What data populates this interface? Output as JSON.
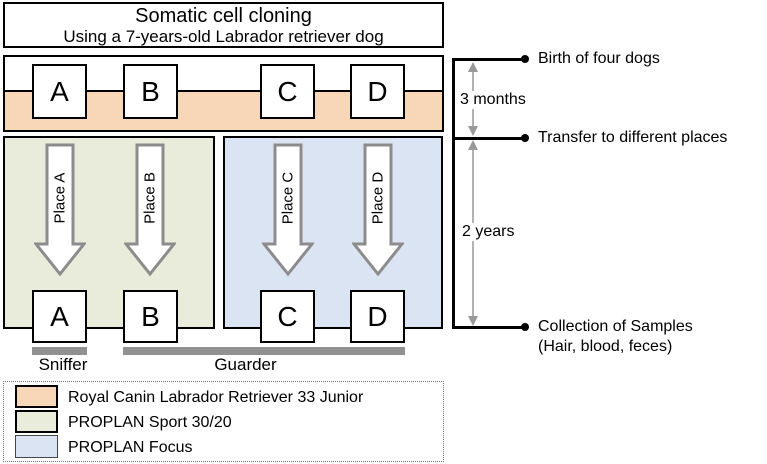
{
  "title": {
    "line1": "Somatic cell cloning",
    "line2": "Using a 7-years-old Labrador retriever dog"
  },
  "clones": {
    "top_boxes": [
      "A",
      "B",
      "C",
      "D"
    ],
    "place_arrows": [
      "Place A",
      "Place B",
      "Place C",
      "Place D"
    ],
    "bottom_boxes": [
      "A",
      "B",
      "C",
      "D"
    ]
  },
  "roles": {
    "sniffer": "Sniffer",
    "guarder": "Guarder"
  },
  "timeline": {
    "events": [
      {
        "label": "Birth of four dogs"
      },
      {
        "label": "Transfer to different places"
      },
      {
        "label": "Collection of Samples",
        "label2": "(Hair, blood, feces)"
      }
    ],
    "durations": [
      "3 months",
      "2 years"
    ]
  },
  "legend": {
    "items": [
      {
        "label": "Royal Canin Labrador Retriever 33 Junior",
        "color": "#F8D7B8"
      },
      {
        "label": "PROPLAN Sport 30/20",
        "color": "#E9ECDA"
      },
      {
        "label": "PROPLAN Focus",
        "color": "#DBE4F2"
      }
    ]
  },
  "colors": {
    "junior_food_band": "#F8D7B8",
    "sniffer_panel": "#E9ECDA",
    "guarder_panel": "#DBE4F2",
    "gray_bar": "#919191",
    "big_arrow_outline": "#8C8C8C",
    "timeline_arrow": "#999999"
  }
}
